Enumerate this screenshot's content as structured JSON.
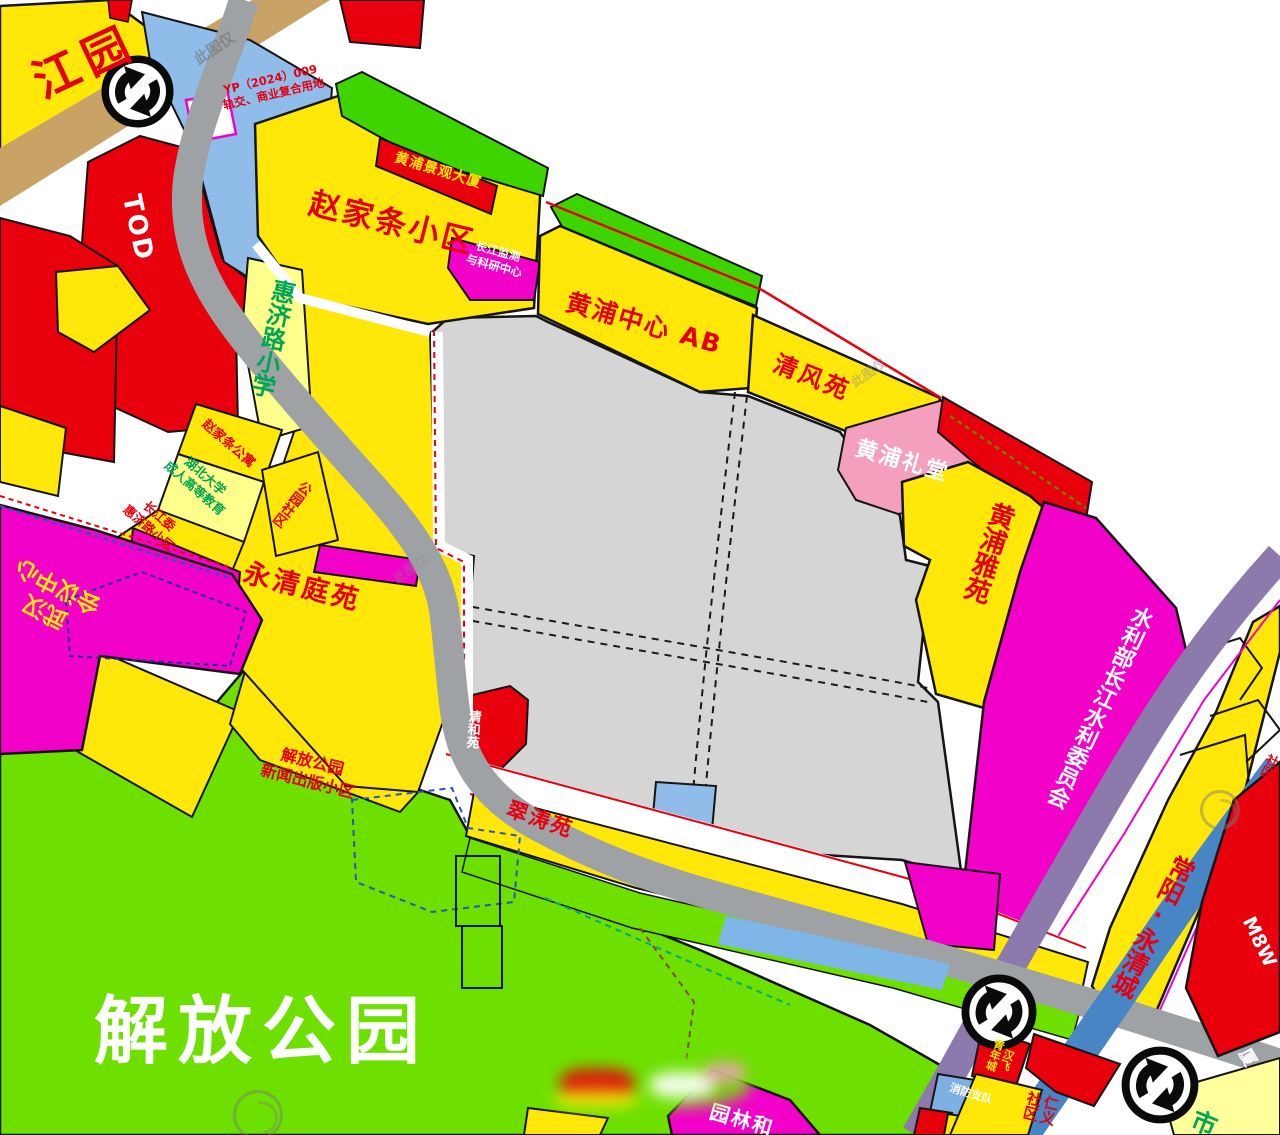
{
  "map": {
    "title_note": "urban planning zoning map",
    "labels": {
      "jiangyuan": "江园",
      "yp_line1": "YP（2024）009",
      "yp_line2": "轨交、商业复合用地",
      "tod": "TOD",
      "zhaojiatiao_xiaoqu": "赵家条小区",
      "huangpu_jingguan_dasha": "黄浦景观大厦",
      "changjiang_jiance_line1": "长江监测",
      "changjiang_jiance_line2": "与科研中心",
      "huijilu_xiaoxue": "惠济路小学",
      "huangpu_zhongxin_ab": "黄浦中心 AB",
      "qingfengyuan": "清风苑",
      "huangpu_litang": "黄浦礼堂",
      "huangpu_yayuan": "黄浦雅苑",
      "shuilibu": "水利部长江水利委员会",
      "changyang_yongqingcheng": "常阳·永清城",
      "zhaojiatiao_gongyu": "赵家条公寓",
      "hubei_daxue_line1": "湖北大学",
      "hubei_daxue_line2": "成人高等教育",
      "changjiangwei_line1": "长江委",
      "changjiangwei_line2": "惠济路小区",
      "gongyuan_shequ": "公园社区",
      "wuhan_huiyi_line1": "武汉",
      "wuhan_huiyi_line2": "会议中心",
      "yongqing_tingyuan": "永清庭苑",
      "jiefang_xinwen_line1": "解放公园",
      "jiefang_xinwen_line2": "新闻出版小区",
      "qingheyuan": "清和苑",
      "cuitaoyuan": "翠涛苑",
      "jiefang_gongyuan": "解放公园",
      "yuanlin": "园林和",
      "hanfei_line1": "汉飞",
      "hanfei_line2": "青年城",
      "xiaofang_zhidui": "消防支队",
      "renyi_line1": "仁义",
      "renyi_line2": "社区",
      "shi_fragment": "市",
      "shequ_fragment": "社区",
      "m8w_fragment": "M8W",
      "sha_fragment": "厦"
    },
    "watermark": {
      "text": "此图仅"
    },
    "colors": {
      "yellow": "#FFE70A",
      "pale_yellow": "#FFFF8C",
      "red": "#E8000D",
      "magenta": "#F201C8",
      "pink": "#F49FBE",
      "green": "#3ED400",
      "park_green": "#6EE000",
      "gray_parcel": "#D5D5D5",
      "road_gray": "#9EA2A5",
      "road_tan": "#C9A265",
      "road_purple": "#8C7AAC",
      "road_blue": "#4785C4",
      "parcel_blue": "#8FBCE8",
      "label_red": "#E50011",
      "label_green": "#00A651",
      "label_white": "#FFFFFF",
      "label_yellow": "#FFE70A"
    }
  }
}
